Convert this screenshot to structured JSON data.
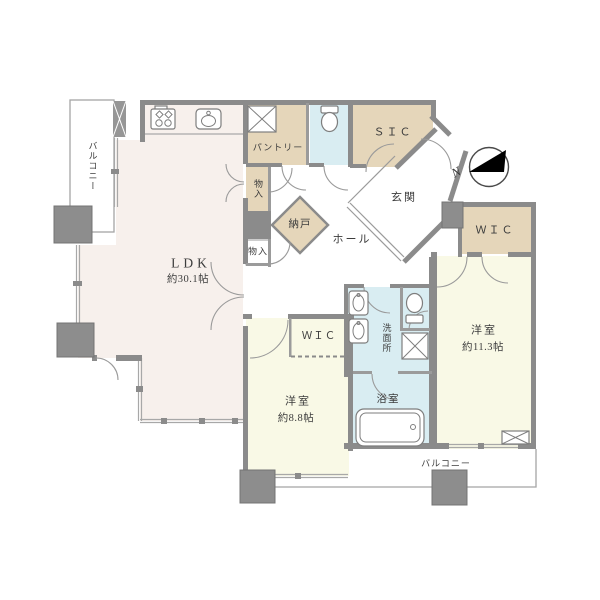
{
  "floorplan": {
    "title": "2LDK apartment floor plan",
    "rooms": {
      "balcony_left": {
        "label": "バルコニー"
      },
      "ldk": {
        "label": "LDK",
        "area": "約30.1帖"
      },
      "pantry": {
        "label": "パントリー"
      },
      "storage_upper": {
        "label": "物入"
      },
      "nando": {
        "label": "納戸"
      },
      "storage_lower": {
        "label": "物入"
      },
      "hall": {
        "label": "ホール"
      },
      "genkan": {
        "label": "玄関"
      },
      "sic": {
        "label": "ＳＩＣ"
      },
      "wic_right": {
        "label": "ＷＩＣ"
      },
      "wic_left": {
        "label": "ＷＩＣ"
      },
      "washroom": {
        "label": "洗面所"
      },
      "bedroom_right": {
        "label": "洋室",
        "area": "約11.3帖"
      },
      "bedroom_left": {
        "label": "洋室",
        "area": "約8.8帖"
      },
      "bathroom": {
        "label": "浴室"
      },
      "balcony_bottom": {
        "label": "バルコニー"
      }
    },
    "compass": {
      "label": "N",
      "direction": "north-pointing-left"
    },
    "icons": [
      "gas-stove-icon",
      "kitchen-sink-icon",
      "pantry-shelf-icon",
      "toilet-icon",
      "second-toilet-icon",
      "washbasin-icon",
      "second-washbasin-icon",
      "washer-pan-icon",
      "bathtub-icon",
      "vent-icon",
      "north-compass-icon"
    ],
    "colors": {
      "wall": "#8b8b8b",
      "room_ldk": "#f7f0ec",
      "room_closet_beige": "#e5d6ba",
      "room_wet_blue": "#d9edf2",
      "room_bedroom_yellow": "#f9f9e6",
      "compass_arrow": "#000000",
      "text": "#3c3c3c"
    }
  }
}
